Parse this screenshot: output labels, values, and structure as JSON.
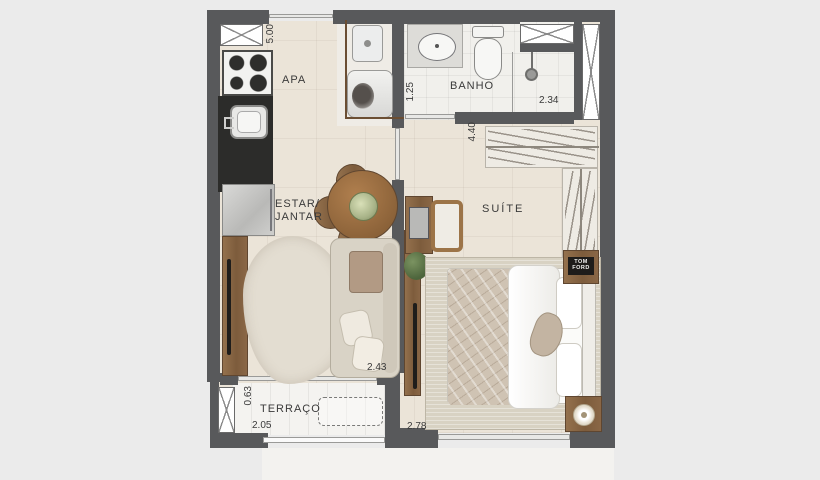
{
  "plan": {
    "rooms": {
      "living": {
        "area_label": "APA",
        "label_line1": "ESTAR/",
        "label_line2": "JANTAR"
      },
      "bathroom": {
        "label": "BANHO"
      },
      "suite": {
        "label": "SUÍTE"
      },
      "terrace": {
        "label": "TERRAÇO"
      }
    },
    "dimensions": {
      "top_width": "5.00",
      "bath_depth": "1.25",
      "shower_width": "2.34",
      "suite_depth": "4.40",
      "living_width": "2.43",
      "terrace_depth": "0.63",
      "terrace_width": "2.05",
      "suite_width": "2.78"
    },
    "decor": {
      "book_line1": "TOM",
      "book_line2": "FORD"
    },
    "colors": {
      "wall": "#58595b",
      "floor": "#ebe4d8",
      "wet": "#f1f0ec",
      "wood": "#8a6746",
      "counter": "#2c2c2a",
      "ink": "#3a3a3a",
      "bg": "#ebebeb"
    }
  }
}
